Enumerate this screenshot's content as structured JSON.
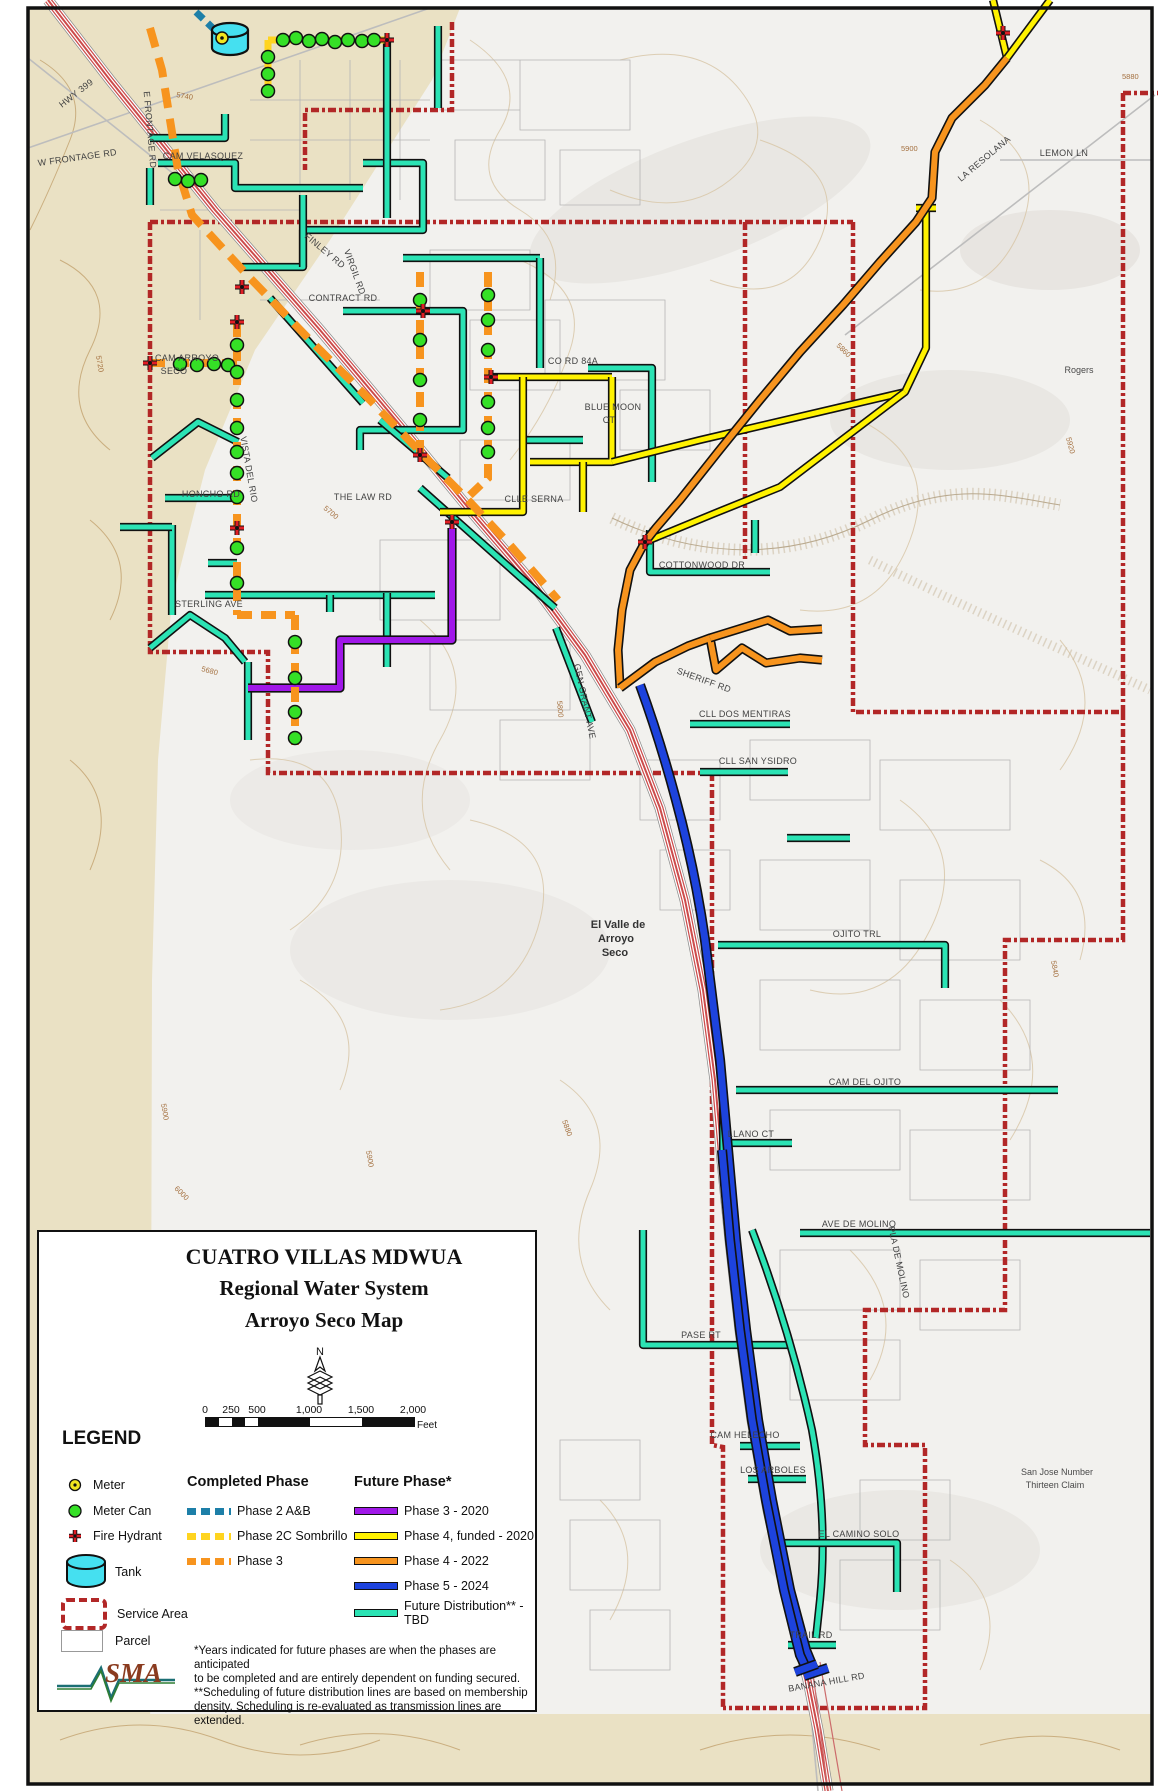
{
  "box": {
    "title": [
      "CUATRO VILLAS MDWUA",
      "Regional Water System",
      "Arroyo Seco Map"
    ],
    "north": "N",
    "scale": {
      "ticks": [
        "0",
        "250",
        "500",
        "1,000",
        "1,500",
        "2,000"
      ],
      "unit": "Feet"
    },
    "legend": {
      "heading": "LEGEND",
      "symbols": [
        "Meter",
        "Meter Can",
        "Fire Hydrant",
        "Tank",
        "Service Area",
        "Parcel"
      ],
      "completed": {
        "title": "Completed Phase",
        "items": [
          "Phase 2 A&B",
          "Phase 2C Sombrillo",
          "Phase 3"
        ]
      },
      "future": {
        "title": "Future Phase*",
        "items": [
          "Phase 3 - 2020",
          "Phase 4, funded - 2020",
          "Phase 4 - 2022",
          "Phase 5 - 2024",
          "Future Distribution** - TBD"
        ]
      }
    },
    "notes": [
      "*Years indicated for future phases are when the phases are anticipated",
      "to be completed and are entirely dependent on funding secured.",
      "**Scheduling of future distribution lines are based on membership",
      "density. Scheduling is re-evaluated as transmission lines are extended."
    ],
    "logo": "SMA"
  },
  "map": {
    "labels": [
      "HWY 399",
      "W FRONTAGE RD",
      "E FRONTAGE RD",
      "CAM VELASQUEZ",
      "FINLEY RD",
      "VIRGIL RD",
      "CONTRACT RD",
      "CO RD 84A",
      "BLUE MOON",
      "CT",
      "CLLE SERNA",
      "THE LAW RD",
      "HONCHO RD",
      "STERLING AVE",
      "VISTA DEL RIO",
      "CAM ARROYO",
      "SECO",
      "GEN GRANT AVE",
      "SHERIFF RD",
      "COTTONWOOD DR",
      "LA RESOLANA",
      "LEMON LN",
      "Rogers",
      "El Valle de",
      "Arroyo",
      "Seco",
      "CLL SAN YSIDRO",
      "CLL DOS MENTIRAS",
      "OJITO TRL",
      "CAM DEL OJITO",
      "LLANO CT",
      "AVE DE MOLINO",
      "PLA DE MOLINO",
      "PASE RT",
      "CAM HELECHO",
      "LOS ARBOLES",
      "EL CAMINO SOLO",
      "TRAIL RD",
      "BANANA HILL RD",
      "San Jose Number",
      "Thirteen Claim"
    ],
    "contours": [
      "5740",
      "5720",
      "5700",
      "5680",
      "5900",
      "5880",
      "5920",
      "5860",
      "5900",
      "6000",
      "5800",
      "5840",
      "5880",
      "5900"
    ]
  },
  "colors": {
    "future_distribution": "#2BE3B4",
    "phase4_funded": "#FFF200",
    "phase3_2020": "#A018E8",
    "phase4_2022": "#F7941E",
    "phase5_2024": "#1D43DD",
    "phase2ab": "#1D7FA8",
    "phase2c_sombrillo": "#FFD41F",
    "phase3_completed": "#F7941E",
    "service_area": "#B22727",
    "meter": "#F2E620",
    "meter_can": "#35E026",
    "fire_hydrant": "#E01E25",
    "tank": "#45E0F0"
  }
}
